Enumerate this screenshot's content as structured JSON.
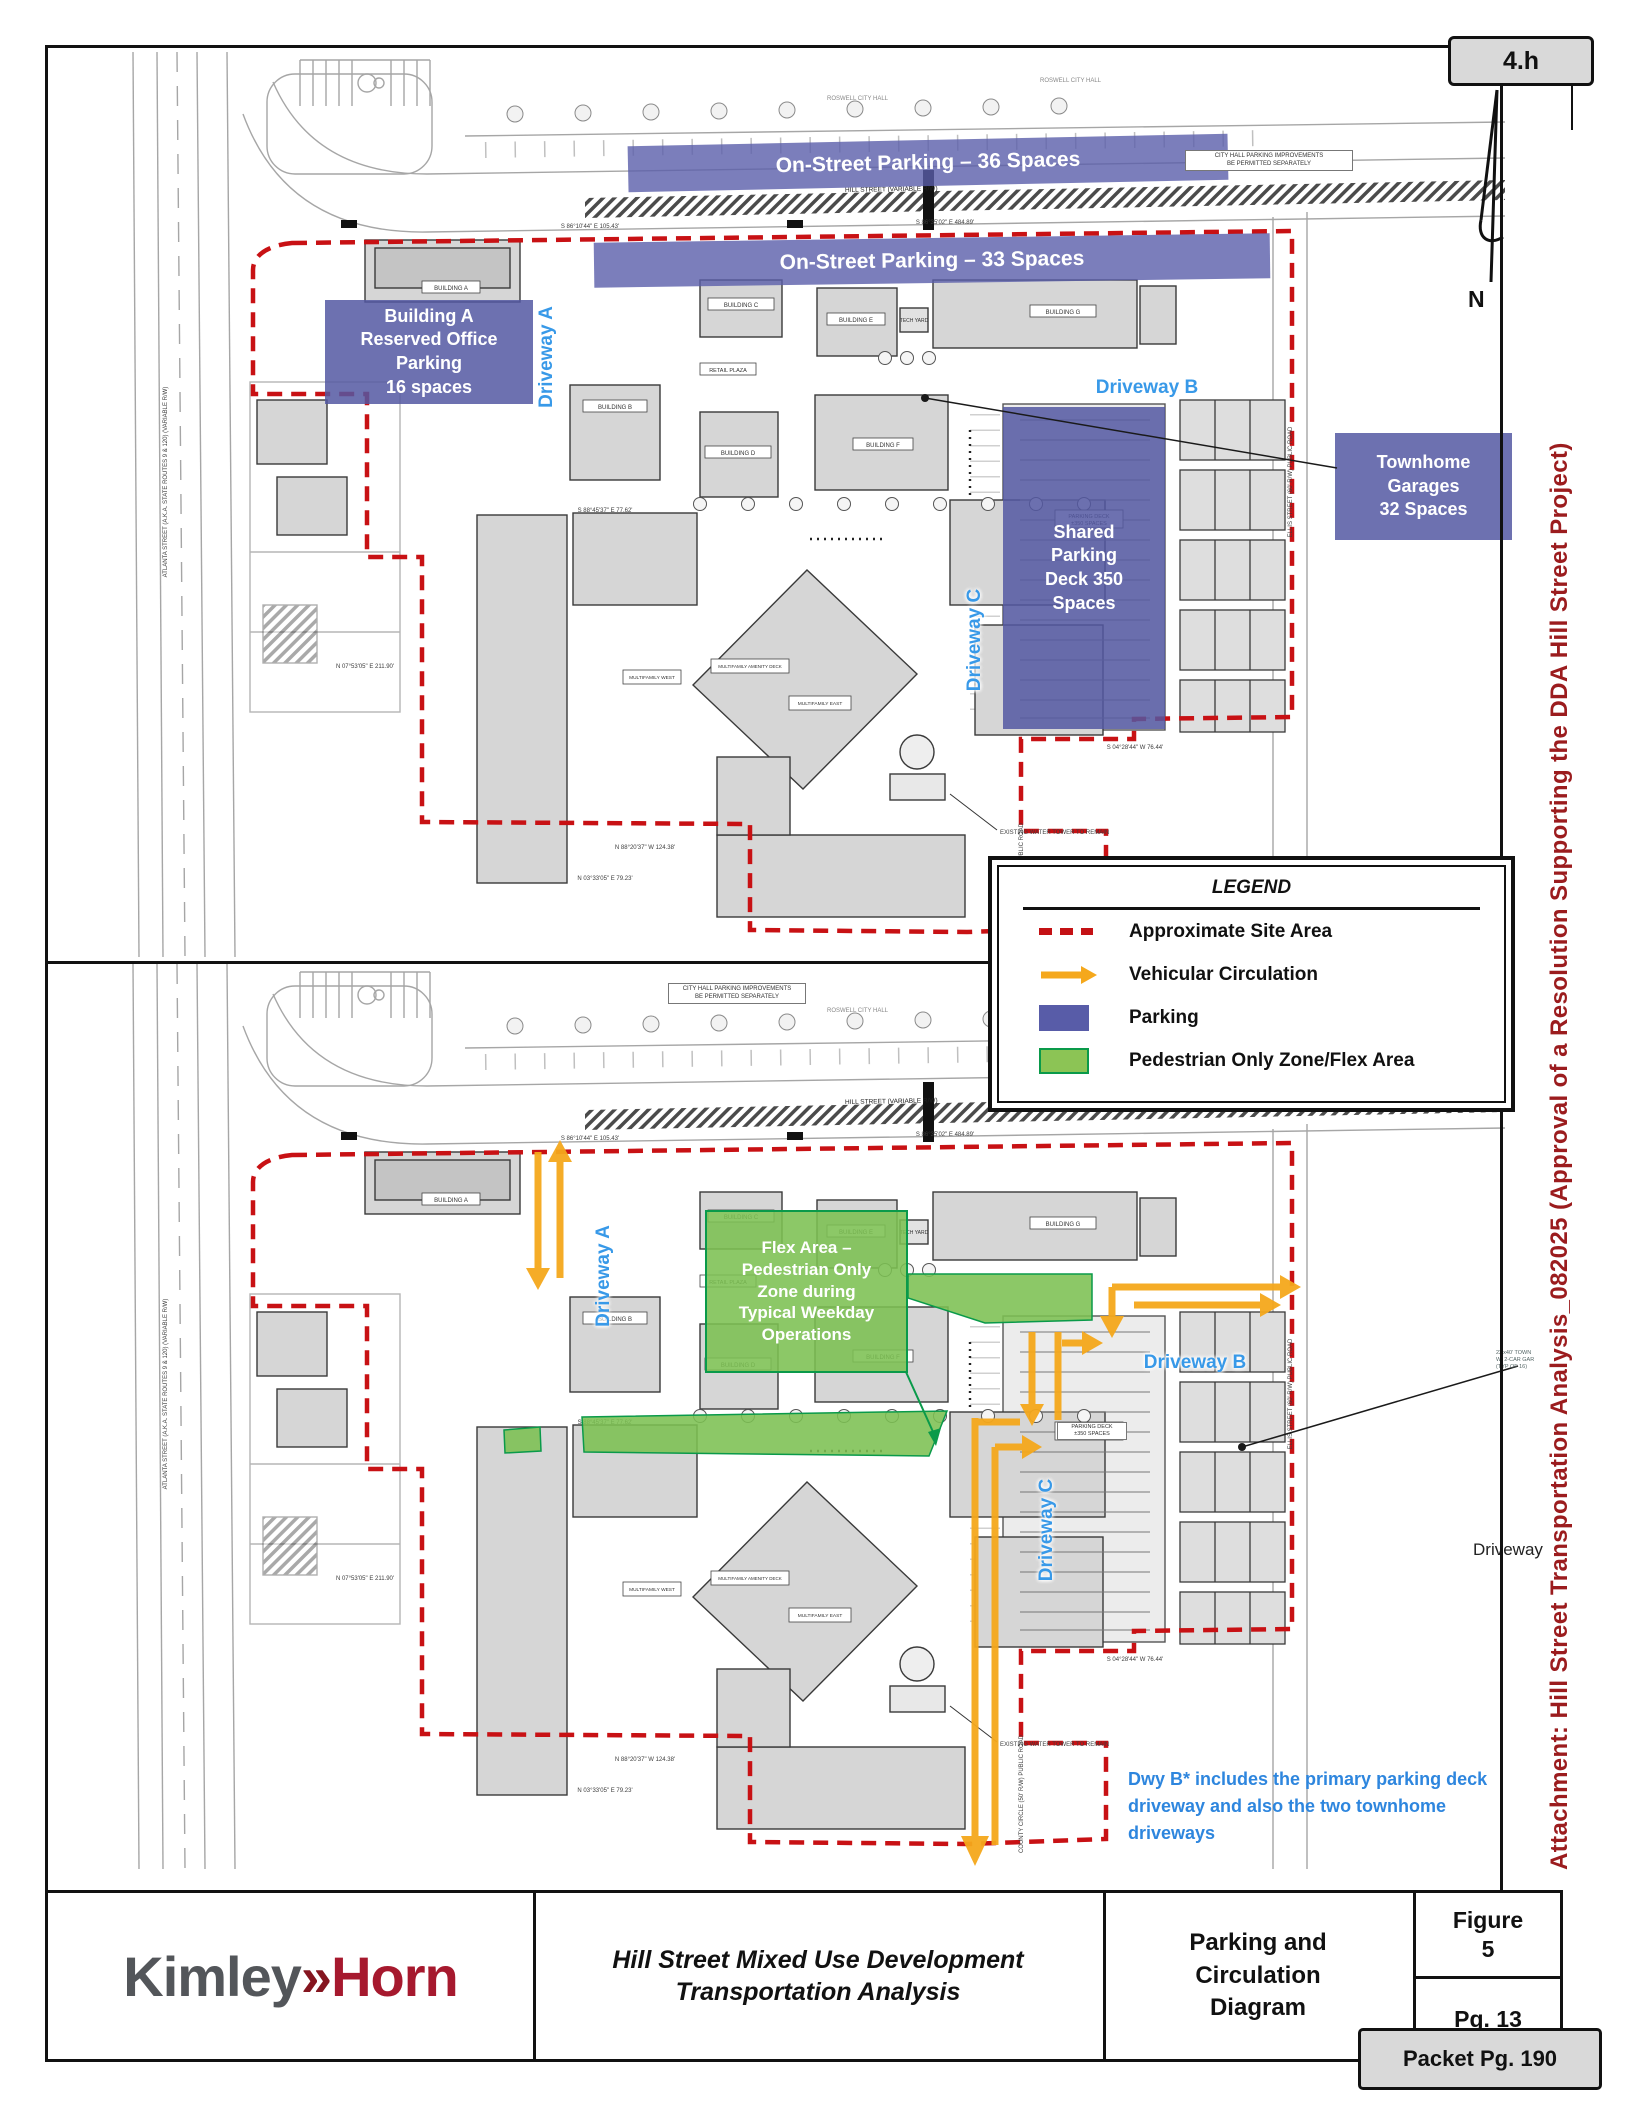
{
  "page": {
    "section_tag": "4.h",
    "north_label": "N",
    "attachment_note": "Attachment: Hill Street Transportation Analysis_082025  (Approval of a Resolution Supporting the DDA Hill Street Project)",
    "packet_page": "Packet Pg. 190"
  },
  "legend": {
    "title": "LEGEND",
    "items": [
      {
        "label": "Approximate Site Area",
        "symbol": "red-dashed-line",
        "color": "#C41114"
      },
      {
        "label": "Vehicular Circulation",
        "symbol": "yellow-arrow",
        "color": "#F5A81C"
      },
      {
        "label": "Parking",
        "symbol": "blue-swatch",
        "color": "#585CA8"
      },
      {
        "label": "Pedestrian Only Zone/Flex Area",
        "symbol": "green-swatch",
        "color": "#8CC455"
      }
    ]
  },
  "top_plan": {
    "onstreet_36": "On-Street Parking – 36 Spaces",
    "onstreet_33": "On-Street Parking – 33 Spaces",
    "building_a": {
      "l1": "Building A",
      "l2": "Reserved Office",
      "l3": "Parking",
      "l4": "16 spaces"
    },
    "shared_deck": {
      "l1": "Shared",
      "l2": "Parking",
      "l3": "Deck 350",
      "l4": "Spaces"
    },
    "townhome": {
      "l1": "Townhome",
      "l2": "Garages",
      "l3": "32 Spaces"
    },
    "driveway_a": "Driveway A",
    "driveway_b": "Driveway B",
    "driveway_c": "Driveway C"
  },
  "bottom_plan": {
    "flex": {
      "l1": "Flex Area –",
      "l2": "Pedestrian Only",
      "l3": "Zone during",
      "l4": "Typical Weekday",
      "l5": "Operations"
    },
    "driveway_a": "Driveway A",
    "driveway_b": "Driveway B",
    "driveway_c": "Driveway C",
    "driveway_partial": "Driveway",
    "note": {
      "l1": "Dwy B* includes the primary parking deck",
      "l2": "driveway and also the two townhome",
      "l3": "driveways"
    },
    "townhome_callout": {
      "l1": "22'x40' TOWN",
      "l2": "W/ 2-CAR GAR",
      "l3": "(TYP OF 16)"
    }
  },
  "plan_base": {
    "roswell_city_hall": "ROSWELL CITY HALL",
    "hill_street": "HILL STREET (VARIABLE R/W)",
    "atlanta_street": "ATLANTA STREET (A.K.A. STATE ROUTES 9 & 120) (VARIABLE R/W)",
    "ellis_street": "ELLIS STREET (60' R/W) PUBLIC ROAD",
    "county_circle": "COUNTY CIRCLE (50' R/W) PUBLIC ROAD",
    "city_hall_note_1": "CITY HALL PARKING IMPROVEMENTS",
    "city_hall_note_2": "BE PERMITTED SEPARATELY",
    "water_tower_note": "EXISTING WATER TOWER TO REMAIN",
    "deck_label_1": "PARKING DECK",
    "deck_label_2": "±350 SPACES",
    "bearing_1": "S 86°10'44\" E  105.43'",
    "bearing_2": "S 86°35'02\" E  484.89'",
    "bearing_3": "S 88°45'37\" E  77.62'",
    "bearing_4": "N 07°53'05\" E  211.90'",
    "bearing_5": "N 88°20'37\" W  124.38'",
    "bearing_6": "N 03°33'05\" E  79.23'",
    "bearing_7": "S 04°28'44\" W  76.44'",
    "buildings": {
      "a": "BUILDING A",
      "b": "BUILDING B",
      "c": "BUILDING C",
      "d": "BUILDING D",
      "e": "BUILDING E",
      "f": "BUILDING F",
      "g": "BUILDING G",
      "retail": "RETAIL PLAZA",
      "tech": "TECH YARD",
      "mf_west": "MULTIFAMILY WEST",
      "mf_east": "MULTIFAMILY EAST",
      "mf_amenity": "MULTIFAMILY AMENITY DECK"
    }
  },
  "title_block": {
    "logo": {
      "kimley": "Kimley",
      "chevron": "»",
      "horn": "Horn"
    },
    "project_l1": "Hill Street Mixed Use Development",
    "project_l2": "Transportation Analysis",
    "sheet_l1": "Parking and",
    "sheet_l2": "Circulation",
    "sheet_l3": "Diagram",
    "figure_label": "Figure",
    "figure_number": "5",
    "page_number": "Pg. 13"
  }
}
